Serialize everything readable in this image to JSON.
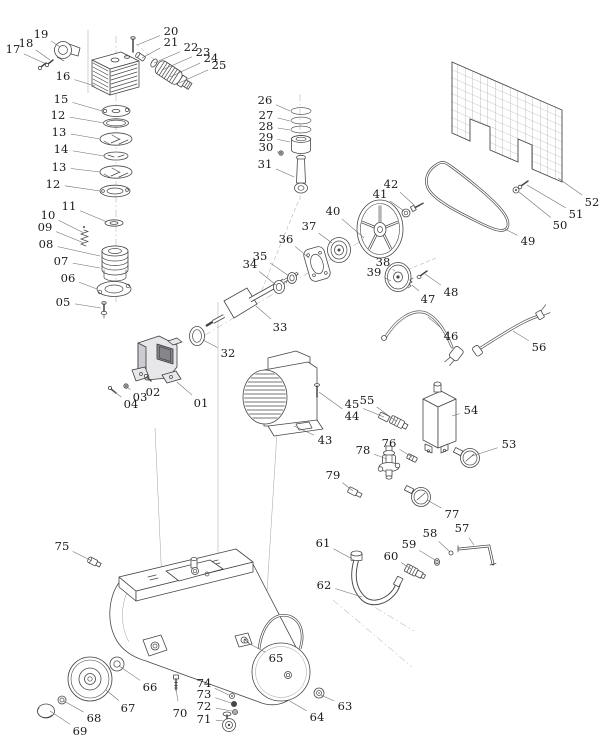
{
  "diagram": {
    "type": "exploded-parts-diagram",
    "subject": "air compressor assembly",
    "canvas": {
      "width": 615,
      "height": 755
    },
    "colors": {
      "background": "#ffffff",
      "line": "#474747",
      "label": "#1b1b1b",
      "leader": "#6b6b6b",
      "dark_fill": "#85858c"
    },
    "label_font_size": 11.5,
    "parts": [
      {
        "n": "17",
        "lx": 13,
        "ly": 49,
        "px": 44,
        "py": 63
      },
      {
        "n": "18",
        "lx": 26,
        "ly": 43,
        "px": 50,
        "py": 60
      },
      {
        "n": "19",
        "lx": 41,
        "ly": 34,
        "px": 60,
        "py": 47
      },
      {
        "n": "16",
        "lx": 63,
        "ly": 76,
        "px": 95,
        "py": 86
      },
      {
        "n": "20",
        "lx": 171,
        "ly": 31,
        "px": 137,
        "py": 45
      },
      {
        "n": "21",
        "lx": 171,
        "ly": 42,
        "px": 142,
        "py": 58
      },
      {
        "n": "22",
        "lx": 191,
        "ly": 47,
        "px": 154,
        "py": 63
      },
      {
        "n": "23",
        "lx": 203,
        "ly": 52,
        "px": 162,
        "py": 70
      },
      {
        "n": "24",
        "lx": 211,
        "ly": 58,
        "px": 170,
        "py": 77
      },
      {
        "n": "25",
        "lx": 219,
        "ly": 65,
        "px": 179,
        "py": 83
      },
      {
        "n": "15",
        "lx": 61,
        "ly": 99,
        "px": 102,
        "py": 111
      },
      {
        "n": "12",
        "lx": 58,
        "ly": 115,
        "px": 104,
        "py": 123
      },
      {
        "n": "13",
        "lx": 59,
        "ly": 132,
        "px": 100,
        "py": 139
      },
      {
        "n": "14",
        "lx": 61,
        "ly": 149,
        "px": 104,
        "py": 156
      },
      {
        "n": "13",
        "lx": 59,
        "ly": 167,
        "px": 100,
        "py": 172
      },
      {
        "n": "12",
        "lx": 53,
        "ly": 184,
        "px": 100,
        "py": 191
      },
      {
        "n": "11",
        "lx": 69,
        "ly": 206,
        "px": 107,
        "py": 222
      },
      {
        "n": "10",
        "lx": 48,
        "ly": 215,
        "px": 84,
        "py": 233
      },
      {
        "n": "09",
        "lx": 45,
        "ly": 227,
        "px": 84,
        "py": 243
      },
      {
        "n": "08",
        "lx": 46,
        "ly": 244,
        "px": 100,
        "py": 256
      },
      {
        "n": "07",
        "lx": 61,
        "ly": 261,
        "px": 100,
        "py": 268
      },
      {
        "n": "06",
        "lx": 68,
        "ly": 278,
        "px": 97,
        "py": 289
      },
      {
        "n": "05",
        "lx": 63,
        "ly": 302,
        "px": 101,
        "py": 308
      },
      {
        "n": "26",
        "lx": 265,
        "ly": 100,
        "px": 290,
        "py": 111
      },
      {
        "n": "27",
        "lx": 266,
        "ly": 115,
        "px": 290,
        "py": 121
      },
      {
        "n": "28",
        "lx": 266,
        "ly": 126,
        "px": 290,
        "py": 130
      },
      {
        "n": "29",
        "lx": 266,
        "ly": 137,
        "px": 290,
        "py": 142
      },
      {
        "n": "30",
        "lx": 266,
        "ly": 147,
        "px": 280,
        "py": 153
      },
      {
        "n": "31",
        "lx": 265,
        "ly": 164,
        "px": 294,
        "py": 177
      },
      {
        "n": "40",
        "lx": 333,
        "ly": 211,
        "px": 364,
        "py": 238
      },
      {
        "n": "41",
        "lx": 380,
        "ly": 194,
        "px": 404,
        "py": 211
      },
      {
        "n": "42",
        "lx": 391,
        "ly": 184,
        "px": 414,
        "py": 205
      },
      {
        "n": "37",
        "lx": 309,
        "ly": 226,
        "px": 332,
        "py": 243
      },
      {
        "n": "36",
        "lx": 286,
        "ly": 239,
        "px": 309,
        "py": 258
      },
      {
        "n": "35",
        "lx": 260,
        "ly": 256,
        "px": 289,
        "py": 276
      },
      {
        "n": "34",
        "lx": 250,
        "ly": 264,
        "px": 276,
        "py": 285
      },
      {
        "n": "38",
        "lx": 383,
        "ly": 262,
        "px": 395,
        "py": 271
      },
      {
        "n": "39",
        "lx": 374,
        "ly": 272,
        "px": 391,
        "py": 281
      },
      {
        "n": "47",
        "lx": 428,
        "ly": 299,
        "px": 412,
        "py": 285
      },
      {
        "n": "48",
        "lx": 451,
        "ly": 292,
        "px": 425,
        "py": 274
      },
      {
        "n": "49",
        "lx": 528,
        "ly": 241,
        "px": 505,
        "py": 229
      },
      {
        "n": "50",
        "lx": 560,
        "ly": 225,
        "px": 519,
        "py": 192
      },
      {
        "n": "51",
        "lx": 576,
        "ly": 214,
        "px": 527,
        "py": 185
      },
      {
        "n": "52",
        "lx": 592,
        "ly": 202,
        "px": 558,
        "py": 178
      },
      {
        "n": "33",
        "lx": 280,
        "ly": 327,
        "px": 256,
        "py": 306
      },
      {
        "n": "32",
        "lx": 228,
        "ly": 353,
        "px": 203,
        "py": 340
      },
      {
        "n": "46",
        "lx": 451,
        "ly": 336,
        "px": 428,
        "py": 317
      },
      {
        "n": "56",
        "lx": 539,
        "ly": 347,
        "px": 513,
        "py": 331
      },
      {
        "n": "02",
        "lx": 153,
        "ly": 392,
        "px": 148,
        "py": 379
      },
      {
        "n": "03",
        "lx": 140,
        "ly": 397,
        "px": 127,
        "py": 387
      },
      {
        "n": "04",
        "lx": 131,
        "ly": 404,
        "px": 113,
        "py": 391
      },
      {
        "n": "01",
        "lx": 201,
        "ly": 403,
        "px": 177,
        "py": 382
      },
      {
        "n": "45",
        "lx": 352,
        "ly": 404,
        "px": 384,
        "py": 417
      },
      {
        "n": "55",
        "lx": 367,
        "ly": 400,
        "px": 396,
        "py": 421
      },
      {
        "n": "44",
        "lx": 352,
        "ly": 416,
        "px": 319,
        "py": 392
      },
      {
        "n": "43",
        "lx": 325,
        "ly": 440,
        "px": 294,
        "py": 426
      },
      {
        "n": "54",
        "lx": 471,
        "ly": 410,
        "px": 452,
        "py": 416
      },
      {
        "n": "76",
        "lx": 389,
        "ly": 443,
        "px": 412,
        "py": 457
      },
      {
        "n": "78",
        "lx": 363,
        "ly": 450,
        "px": 387,
        "py": 459
      },
      {
        "n": "53",
        "lx": 509,
        "ly": 444,
        "px": 472,
        "py": 456
      },
      {
        "n": "79",
        "lx": 333,
        "ly": 475,
        "px": 353,
        "py": 491
      },
      {
        "n": "77",
        "lx": 452,
        "ly": 514,
        "px": 427,
        "py": 500
      },
      {
        "n": "58",
        "lx": 430,
        "ly": 533,
        "px": 450,
        "py": 552
      },
      {
        "n": "57",
        "lx": 462,
        "ly": 528,
        "px": 474,
        "py": 545
      },
      {
        "n": "59",
        "lx": 409,
        "ly": 544,
        "px": 435,
        "py": 560
      },
      {
        "n": "60",
        "lx": 391,
        "ly": 556,
        "px": 411,
        "py": 569
      },
      {
        "n": "61",
        "lx": 323,
        "ly": 543,
        "px": 354,
        "py": 560
      },
      {
        "n": "62",
        "lx": 324,
        "ly": 585,
        "px": 362,
        "py": 597
      },
      {
        "n": "75",
        "lx": 62,
        "ly": 546,
        "px": 92,
        "py": 561
      },
      {
        "n": "66",
        "lx": 150,
        "ly": 687,
        "px": 119,
        "py": 666
      },
      {
        "n": "67",
        "lx": 128,
        "ly": 708,
        "px": 106,
        "py": 690
      },
      {
        "n": "68",
        "lx": 94,
        "ly": 718,
        "px": 64,
        "py": 701
      },
      {
        "n": "69",
        "lx": 80,
        "ly": 731,
        "px": 50,
        "py": 711
      },
      {
        "n": "70",
        "lx": 180,
        "ly": 713,
        "px": 176,
        "py": 689
      },
      {
        "n": "74",
        "lx": 204,
        "ly": 683,
        "px": 229,
        "py": 695
      },
      {
        "n": "73",
        "lx": 204,
        "ly": 694,
        "px": 231,
        "py": 703
      },
      {
        "n": "72",
        "lx": 204,
        "ly": 706,
        "px": 232,
        "py": 711
      },
      {
        "n": "71",
        "lx": 204,
        "ly": 719,
        "px": 224,
        "py": 721
      },
      {
        "n": "65",
        "lx": 276,
        "ly": 658,
        "px": 248,
        "py": 643
      },
      {
        "n": "64",
        "lx": 317,
        "ly": 717,
        "px": 288,
        "py": 700
      },
      {
        "n": "63",
        "lx": 345,
        "ly": 706,
        "px": 321,
        "py": 695
      }
    ]
  }
}
